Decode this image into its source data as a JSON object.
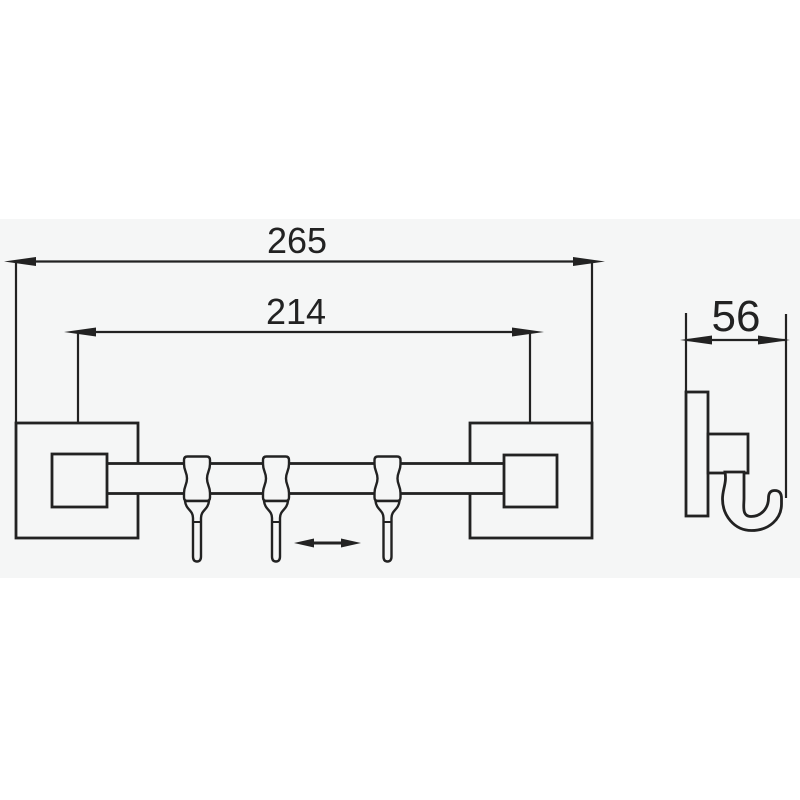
{
  "drawing": {
    "type": "technical-dimension-drawing",
    "subject": "wall-mounted sliding hook rail, front and side views",
    "labels": {
      "overall_width": "265",
      "hole_spacing": "214",
      "side_depth": "56"
    },
    "icons": {
      "slide_indicator": "left-right-double-arrow",
      "dimension_arrowheads": "slender-filled-triangles"
    },
    "colors": {
      "paper": "#f5f6f6",
      "background": "#ffffff",
      "line": "#222222"
    }
  }
}
